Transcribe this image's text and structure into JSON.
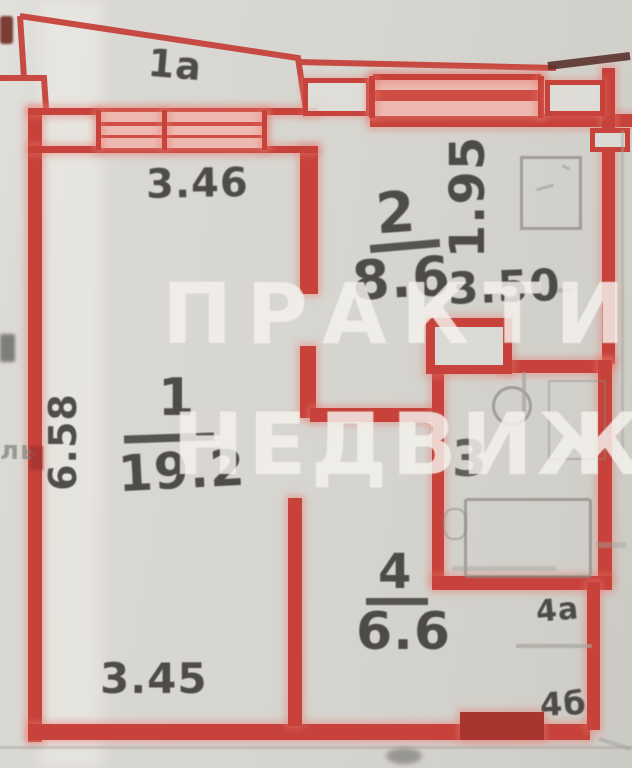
{
  "document_type": "apartment floor plan (BTI scan photo)",
  "watermark": {
    "line1": "ПРАКТИ",
    "line2": "НЕДВИЖИМ",
    "edge_fragment": "ль"
  },
  "balcony": {
    "label": "1а"
  },
  "rooms": {
    "living": {
      "number": "1",
      "area": "19.2"
    },
    "kitchen": {
      "number": "2",
      "area": "8.6"
    },
    "bathroom": {
      "number": "3"
    },
    "hallway": {
      "number": "4",
      "area": "6.6"
    }
  },
  "closets": {
    "a": {
      "label": "4а"
    },
    "b": {
      "label": "4б"
    }
  },
  "dimensions": {
    "room1_top": "3.46",
    "room1_bottom": "3.45",
    "room1_left": "6.58",
    "kitchen_right": "1.95",
    "kitchen_width": "3.50"
  },
  "colors": {
    "wall_red": "#c6423a",
    "hatch_pink": "#edb9b0",
    "paper_bg": "#d7d5d0",
    "watermark_white": "#f4f2ed",
    "pencil_gray": "#8f8d88",
    "ink_dark": "#3a3836"
  }
}
